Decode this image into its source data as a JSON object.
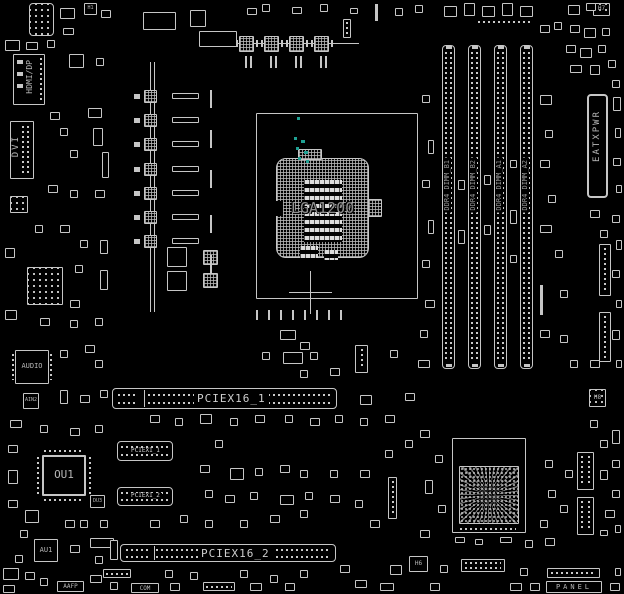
{
  "colors": {
    "background": "#000000",
    "outline": "#c6c6c6",
    "label": "#b6b6b6",
    "accent_teal": "#1fa193"
  },
  "cpu": {
    "socket_label": "LGA1200"
  },
  "memory": {
    "slots": [
      {
        "label": "DDR4 DIMM_B1"
      },
      {
        "label": "DDR4 DIMM_B2"
      },
      {
        "label": "DDR4 DIMM_A1"
      },
      {
        "label": "DDR4 DIMM_A2"
      }
    ]
  },
  "power": {
    "atx_connector_label": "EATXPWR"
  },
  "expansion_slots": {
    "pciex16_1": "PCIEX16_1",
    "pciex16_2": "PCIEX16_2",
    "pciex1_1": "PCIEX1_1",
    "pciex1_2": "PCIEX1_2"
  },
  "rear_io": {
    "hdmi_dp_label": "HDMI/DP",
    "dvi_label": "DVI"
  },
  "chips": {
    "audio_label": "AUDIO",
    "ain2_label": "AIN2",
    "ou1_label": "OU1",
    "au1_label": "AU1",
    "du3_label": "DU3",
    "h1_label": "H1",
    "h7_label": "H7",
    "h8_label": "H8",
    "h6_label": "H6"
  },
  "headers": {
    "aafp_label": "AAFP",
    "com_label": "COM",
    "panel_label": "PANEL"
  }
}
